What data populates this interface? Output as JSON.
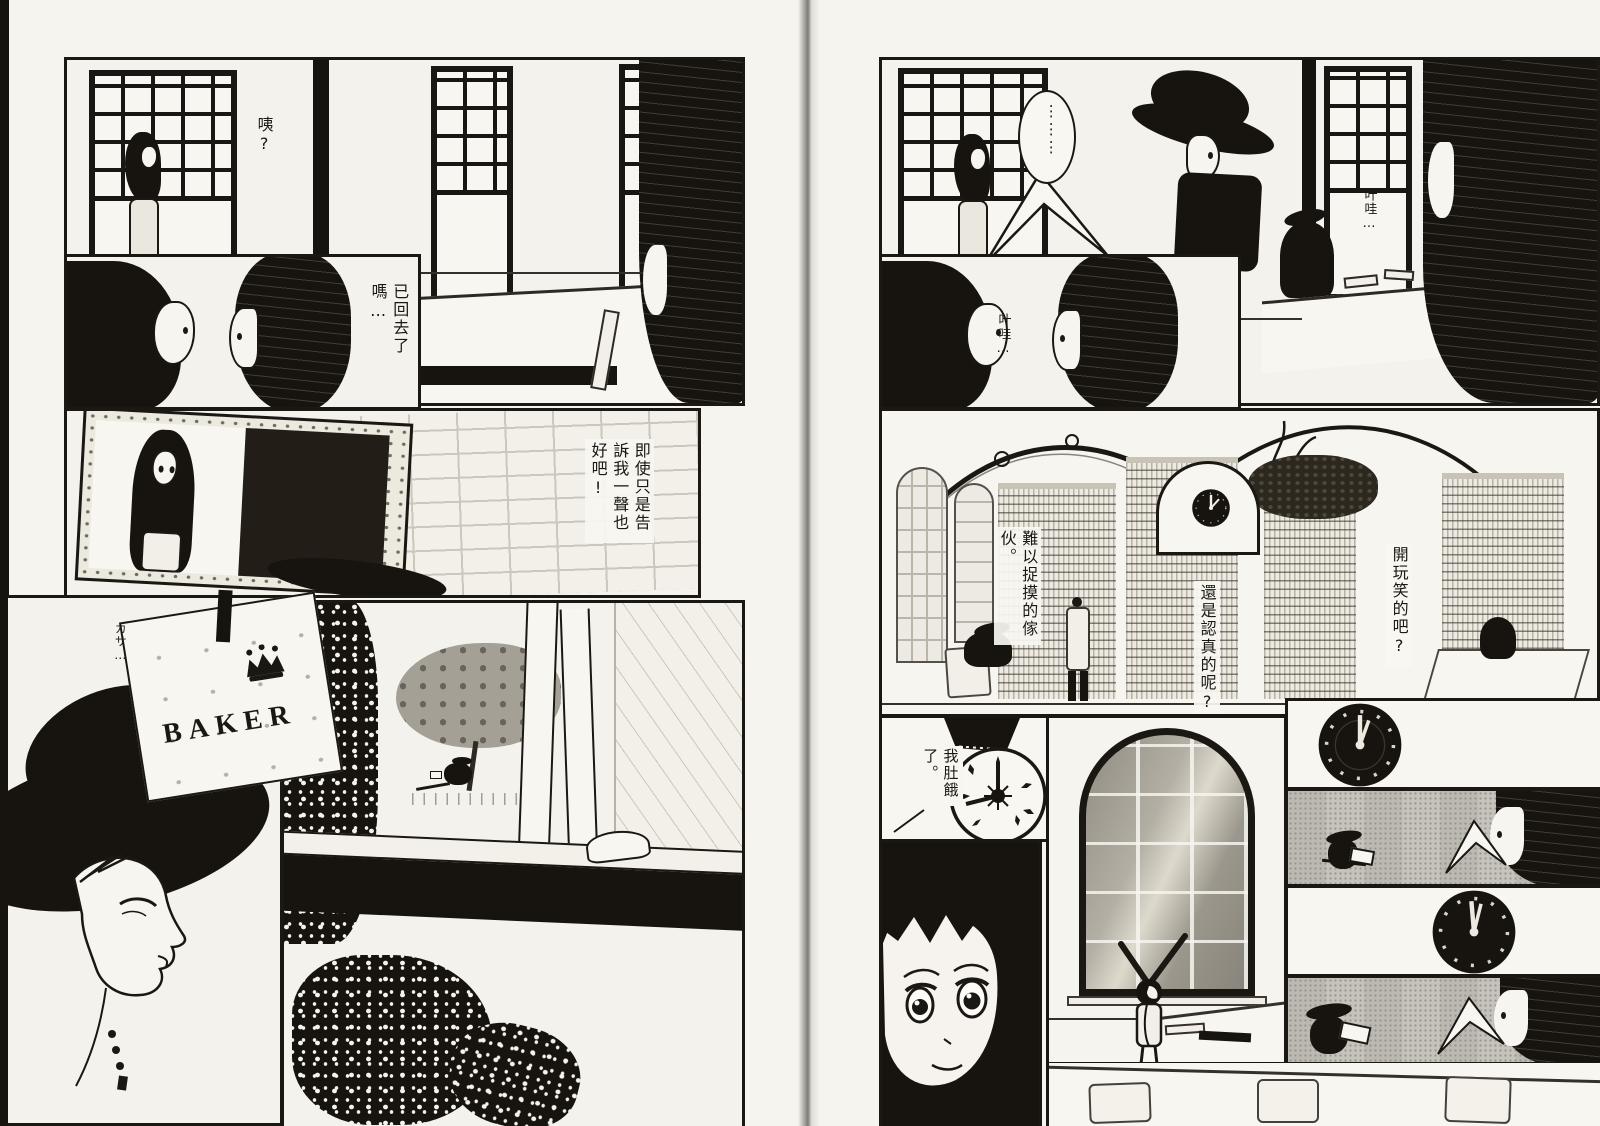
{
  "palette": {
    "paper": "#f4f2ed",
    "ink": "#1b1813",
    "halftone_gray": "#c6c3bc"
  },
  "texts": {
    "left_page": {
      "bubble_eh": "咦?",
      "bubble_gone_back": "已回去了嗎…",
      "bubble_at_least_tell_me": "即使只是告訴我一聲也好吧!",
      "sfx_rustle": "カサ…",
      "bag_brand": "BAKER"
    },
    "right_page": {
      "bubble_silence": "⋮⋮⋮",
      "sfx_yawn_top": "叶哇…",
      "sfx_yawn_left": "叶哇…",
      "bubble_elusive": "難以捉摸的傢伙。",
      "bubble_serious": "還是認真的呢?",
      "bubble_joking": "開玩笑的吧?",
      "bubble_hungry": "我肚餓了。",
      "clock_numerals": "XII I II III IIII V VI VII VIII IX X XI"
    }
  }
}
